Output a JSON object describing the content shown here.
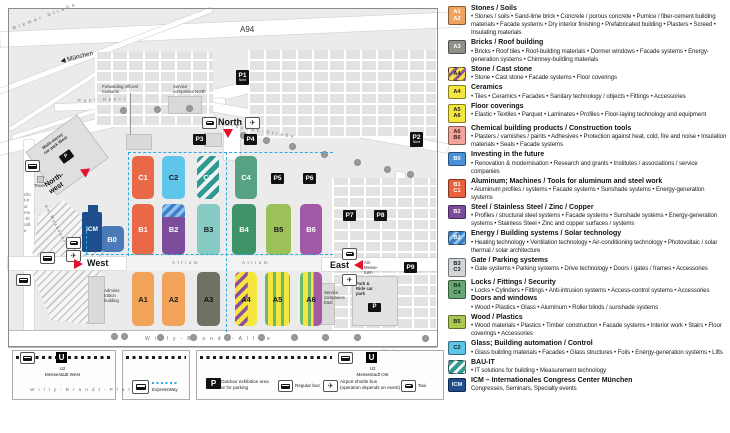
{
  "map": {
    "roads": {
      "riemer": "Riemer Straße",
      "a94": "A94",
      "muenchen": "München",
      "paul_henri_west": "Paul-Henri",
      "paul_henri_east": "Spaak-Straße",
      "olof_palme": "Olof-Palme-Straße",
      "willy_allee": "Willy-Brandt-Allee",
      "willy_platz": "Willy-Brandt-Platz",
      "am_messesee": "Am Messesee",
      "atrium": "Atrium"
    },
    "labels": {
      "forwarding": "Forwarding offices/\nCustoms",
      "service_north": "Service\ncompanies North",
      "service_east": "Service\ncompanies\nEast",
      "admin": "Adminis-\ntration\nbuilding",
      "car_park_west": "Multi-storey\ncar park West",
      "tower": "Tower",
      "am_messeturm": "Am\nMesse-\nturm",
      "park_ride": "Park &\nRide car\npark"
    },
    "entrances": {
      "north": "North",
      "north_west": "North-\nwest",
      "west": "West",
      "east": "East"
    },
    "stations": {
      "west": "U2\nMessestadt West",
      "ost": "U2\nMessestadt Ost"
    },
    "u_letter": "U",
    "p_letter": "P",
    "parking_badges": [
      {
        "label": "P1",
        "sub": "Nord",
        "x": 236,
        "y": 70
      },
      {
        "label": "P2",
        "sub": "Nord",
        "x": 410,
        "y": 132
      },
      {
        "label": "P3",
        "x": 193,
        "y": 134
      },
      {
        "label": "P4",
        "x": 244,
        "y": 134
      },
      {
        "label": "P5",
        "x": 271,
        "y": 173
      },
      {
        "label": "P6",
        "x": 303,
        "y": 173
      },
      {
        "label": "P7",
        "x": 343,
        "y": 210
      },
      {
        "label": "P8",
        "x": 374,
        "y": 210
      },
      {
        "label": "P9",
        "x": 404,
        "y": 262
      }
    ],
    "halls": [
      {
        "id": "C1",
        "x": 132,
        "y": 156,
        "w": 22,
        "h": 43,
        "fill": "#E86847",
        "text": "#fff"
      },
      {
        "id": "C2",
        "x": 162,
        "y": 156,
        "w": 23,
        "h": 43,
        "fill": "#5FC6EA",
        "text": "#1a1a1a"
      },
      {
        "id": "C3",
        "x": 197,
        "y": 156,
        "w": 22,
        "h": 43,
        "pattern": "teal-stripes",
        "text": "#fff"
      },
      {
        "id": "C4",
        "x": 235,
        "y": 156,
        "w": 22,
        "h": 43,
        "fill": "#57A184",
        "text": "#fff"
      },
      {
        "id": "B0",
        "x": 100,
        "y": 226,
        "w": 24,
        "h": 26,
        "fill": "#4B7AB8",
        "text": "#fff"
      },
      {
        "id": "B1",
        "x": 132,
        "y": 204,
        "w": 22,
        "h": 51,
        "fill": "#E86847",
        "text": "#fff"
      },
      {
        "id": "B2",
        "x": 162,
        "y": 204,
        "w": 23,
        "h": 51,
        "fill": "#7C4D9B",
        "text": "#fff",
        "pattern": "blue-top"
      },
      {
        "id": "B3",
        "x": 197,
        "y": 204,
        "w": 23,
        "h": 51,
        "fill": "#85CBC3",
        "text": "#1a1a1a"
      },
      {
        "id": "B4",
        "x": 232,
        "y": 204,
        "w": 24,
        "h": 51,
        "fill": "#3E9468",
        "text": "#fff"
      },
      {
        "id": "B5",
        "x": 266,
        "y": 204,
        "w": 25,
        "h": 51,
        "fill": "#9CC159",
        "text": "#1a1a1a"
      },
      {
        "id": "B6",
        "x": 300,
        "y": 204,
        "w": 22,
        "h": 51,
        "fill": "#A35AA6",
        "text": "#fff"
      },
      {
        "id": "A1",
        "x": 132,
        "y": 272,
        "w": 22,
        "h": 54,
        "fill": "#F1A35A",
        "text": "#1a1a1a"
      },
      {
        "id": "A2",
        "x": 162,
        "y": 272,
        "w": 23,
        "h": 54,
        "fill": "#F1A35A",
        "text": "#1a1a1a"
      },
      {
        "id": "A3",
        "x": 197,
        "y": 272,
        "w": 23,
        "h": 54,
        "fill": "#6F7263",
        "text": "#111"
      },
      {
        "id": "A4",
        "x": 235,
        "y": 272,
        "w": 22,
        "h": 54,
        "pattern": "yellow-purple",
        "text": "#1a1a1a"
      },
      {
        "id": "A5",
        "x": 265,
        "y": 272,
        "w": 25,
        "h": 54,
        "pattern": "yellow-green",
        "text": "#1a1a1a"
      },
      {
        "id": "A6",
        "x": 300,
        "y": 272,
        "w": 22,
        "h": 54,
        "pattern": "a6-mix",
        "text": "#1a1a1a"
      }
    ],
    "icm_label": "ICM"
  },
  "map_legend": {
    "expressway": "ExpressWay",
    "outdoor": "Outdoor exhibition area\nor for parking",
    "regular_bus": "Regular bus",
    "airport_shuttle": "Airport shuttle bus\n(operation depends on event)",
    "taxi": "Taxi"
  },
  "colors": {
    "accent_red": "#E8112D",
    "expressway_cyan": "#29ABE2",
    "badge_black": "#111111"
  },
  "legend": {
    "entries": [
      {
        "codes": [
          "A1",
          "A2"
        ],
        "color": "#F0A35E",
        "text_color": "#fff",
        "title": "Stones / Soils",
        "bullets": "• Stones / soils • Sand-lime brick • Concrete / porous concrete • Pumice / fiber-cement building materials • Facade systems • Dry interior finishing • Prefabricated building • Plasters • Screed • Insulating materials"
      },
      {
        "codes": [
          "A3"
        ],
        "color": "#8F8F87",
        "text_color": "#fff",
        "title": "Bricks / Roof building",
        "bullets": "• Bricks • Roof tiles • Roof-building materials • Dormer windows • Facade systems • Energy-generation systems • Chimney-building materials"
      },
      {
        "codes": [
          "A4"
        ],
        "pattern": "yp",
        "text_color": "#1a1a1a",
        "title": "Stone / Cast stone",
        "bullets": "• Stone • Cast stone • Facade systems • Floor coverings"
      },
      {
        "codes": [
          "A4"
        ],
        "color": "#F5E53F",
        "text_color": "#1a1a1a",
        "title": "Ceramics",
        "bullets": "• Tiles • Ceramics • Facades • Sanitary technology / objects • Fittings • Accessories"
      },
      {
        "codes": [
          "A5",
          "A6"
        ],
        "color": "#F5E53F",
        "text_color": "#1a1a1a",
        "title": "Floor coverings",
        "bullets": "• Elastic • Textiles • Parquet • Laminates • Profiles • Floor-laying technology and equipment"
      },
      {
        "codes": [
          "A6",
          "B6"
        ],
        "color": "#F2A49B",
        "text_color": "#3a1a1a",
        "title": "Chemical building products / Construction tools",
        "bullets": "• Plasters / varnishes / paints • Adhesives • Protection against heat, cold, fire and noise • Insulation materials • Seals • Facade systems"
      },
      {
        "codes": [
          "B0"
        ],
        "color": "#4A90D9",
        "text_color": "#fff",
        "title": "Investing in the future",
        "bullets": "• Renovation & modernisation • Research and grants • Institutes / associations / service companies"
      },
      {
        "codes": [
          "B1",
          "C1"
        ],
        "color": "#E8613C",
        "text_color": "#fff",
        "title": "Aluminum; Machines / Tools for aluminum and steel work",
        "bullets": "• Aluminum profiles / systems • Facade systems • Sunshade systems • Energy-generation systems"
      },
      {
        "codes": [
          "B2"
        ],
        "color": "#7C4D9B",
        "text_color": "#fff",
        "title": "Steel / Stainless Steel / Zinc / Copper",
        "bullets": "• Profiles / structural steel systems • Facade systems • Sunshade systems • Energy-generation systems • Stainless Steel • Zinc and copper surfaces / systems"
      },
      {
        "codes": [
          "B2"
        ],
        "pattern": "blue",
        "text_color": "#fff",
        "title": "Energy / Building systems / Solar technology",
        "bullets": "• Heating technology • Ventilation technology • Air-conditioning technology • Photovoltaic / solar thermal / solar architecture"
      },
      {
        "codes": [
          "B3",
          "C3"
        ],
        "color": "#D2D6D9",
        "text_color": "#1a1a1a",
        "title": "Gate / Parking systems",
        "bullets": "• Gate systems • Parking systems • Drive technology • Doors / gates / frames • Accessories"
      },
      {
        "codes": [
          "B4",
          "C4"
        ],
        "color": "#69A873",
        "text_color": "#10301a",
        "title": "Locks / Fittings / Security",
        "bullets": "• Locks • Cylinders • Fittings • Anti-intrusion systems • Access-control systems • Accessories",
        "extra_title": "Doors and windows",
        "extra_bullets": "• Wood • Plastics • Glass • Aluminum • Roller blinds / sunshade systems"
      },
      {
        "codes": [
          "B5"
        ],
        "color": "#A9C84F",
        "text_color": "#1a1a1a",
        "title": "Wood / Plastics",
        "bullets": "• Wood materials • Plastics • Timber construction • Facade systems • Interior work • Stairs • Floor coverings • Accessories"
      },
      {
        "codes": [
          "C2"
        ],
        "color": "#5BC5EA",
        "text_color": "#1a1a1a",
        "title": "Glass; Building automation / Control",
        "bullets": "• Glass building materials • Facades • Glass structures • Foils • Energy-generation systems • Lifts"
      },
      {
        "codes": [],
        "pattern": "teal",
        "text_color": "#fff",
        "title": "BAU-IT",
        "bullets": "• IT solutions for building • Measurement technology"
      },
      {
        "codes": [
          "ICM"
        ],
        "color": "#1E4E8C",
        "text_color": "#fff",
        "title": "ICM – Internationales Congress Center München",
        "bullets": "Congresses, Seminars, Specialty events"
      }
    ]
  }
}
